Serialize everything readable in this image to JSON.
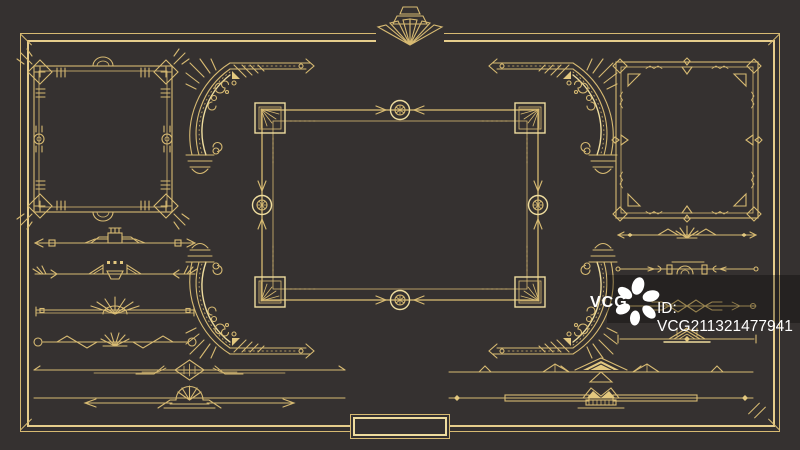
{
  "palette": {
    "background": "#353130",
    "gold": "#D7BA72",
    "gold_bright": "#EEDC9E",
    "watermark_band": "rgba(0,0,0,0.30)",
    "watermark_text": "#FFFFFF"
  },
  "watermark": {
    "brand": "VCG",
    "id_text": "ID: VCG211321477941",
    "logo_icon": "vcg-pinwheel-icon"
  },
  "ornaments": {
    "outer_border": "double-line-border",
    "top_center": "deco-fan-crest",
    "left_frame": "ornate-corner-frame",
    "center_frame": "sunburst-corner-frame",
    "right_frame": "triangle-accent-frame",
    "arc_corners": "rounded-corner-bracket",
    "left_dividers": [
      "gate-arrow-divider",
      "fan-triangle-divider",
      "palm-fan-divider",
      "zigzag-shell-divider"
    ],
    "right_dividers": [
      "diamond-fan-divider",
      "arch-divider",
      "lattice-divider",
      "butterfly-divider"
    ],
    "bottom_left_dividers": [
      "diamond-bracket-rule",
      "sunrise-arrow-rule"
    ],
    "bottom_right_dividers": [
      "chevron-peak-rule",
      "crown-zigzag-rule"
    ],
    "bottom_center": "empty-nameplate"
  }
}
